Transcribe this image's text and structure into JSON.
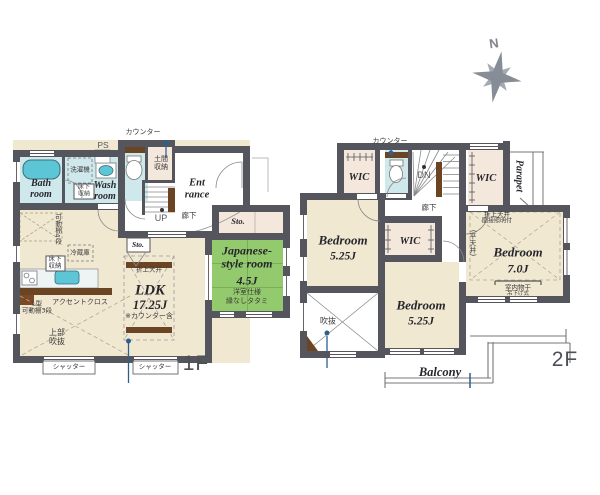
{
  "compass": {
    "north_label": "N"
  },
  "colors": {
    "wall": "#54555d",
    "floor_beige": "#f1e8d2",
    "water_room_blue": "#cfe8eb",
    "fixture_blue": "#5cc6d7",
    "tatami_green": "#94ca6e",
    "closet_pink": "#f4e7dc",
    "wood_brown": "#6b4423",
    "accent_blue": "#2d5f8d"
  },
  "floor1": {
    "floor_label": "1F",
    "labels": {
      "counter": "カウンター",
      "ps": "PS",
      "washer": "洗濯機",
      "bath_room": [
        "Bath",
        "room"
      ],
      "underfloor_storage_wash": [
        "床下",
        "収納"
      ],
      "wash_room": [
        "Wash",
        "room"
      ],
      "doma_storage": [
        "土間",
        "収納"
      ],
      "entrance": [
        "Ent",
        "rance"
      ],
      "up": "UP",
      "hallway": "廊下",
      "storage_hall": "Sto.",
      "storage_ldk": "Sto.",
      "movable_shelf_4": "可動棚4段",
      "fridge": "冷蔵庫",
      "underfloor_storage_ldk": [
        "床下",
        "収納"
      ],
      "raised_ceiling": "折上天井",
      "ldk_name": "LDK",
      "ldk_size": "17.25J",
      "ldk_note": "※カウンター含",
      "accent_cloth": "アクセントクロス",
      "l_shelf": [
        "L型",
        "可動棚3段"
      ],
      "upper_void": [
        "上部",
        "吹抜"
      ],
      "jp_room": [
        "Japanese-",
        "style room"
      ],
      "jp_size": "4.5J",
      "jp_note1": "洋室仕様",
      "jp_note2": "縁なしタタミ",
      "shutter1": "シャッター",
      "shutter2": "シャッター"
    }
  },
  "floor2": {
    "floor_label": "2F",
    "labels": {
      "counter": "カウンター",
      "wic1": "WIC",
      "wic2": "WIC",
      "wic3": "WIC",
      "dn": "DN",
      "hallway": "廊下",
      "parapet": "Parapet",
      "bedroom1_name": "Bedroom",
      "bedroom1_size": "5.25J",
      "bedroom2_name": "Bedroom",
      "bedroom2_size": "5.25J",
      "bedroom3_name": "Bedroom",
      "bedroom3_size": "7.0J",
      "raised_ceiling": "折上天井",
      "indirect_light": "間接照明付",
      "flat_ceiling": "(平天井)",
      "drying1": "室内物干",
      "drying2": "吊下げ式",
      "void": "吹抜",
      "balcony": "Balcony"
    }
  }
}
